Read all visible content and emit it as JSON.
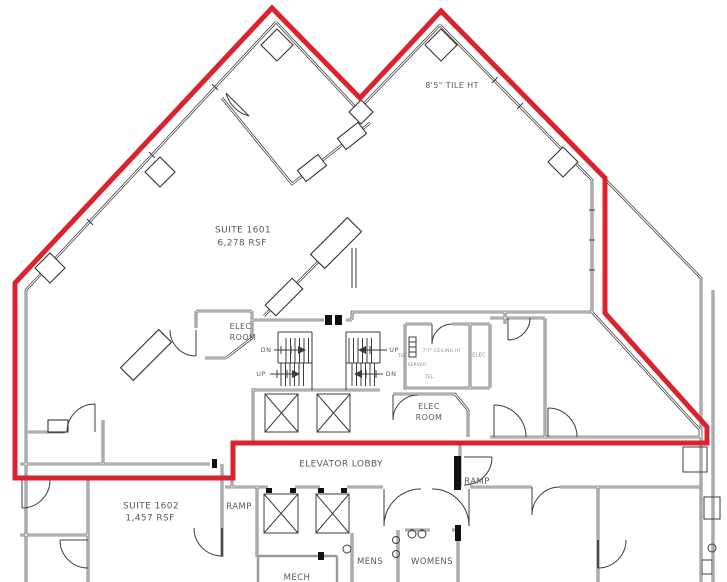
{
  "plan": {
    "colors": {
      "suite_outline": "#d9232e",
      "walls": "#2e2e2e",
      "labels": "#5a5a5a"
    },
    "labels": {
      "tile_height": "8'5\" TILE HT",
      "suite_1601_name": "SUITE 1601",
      "suite_1601_area": "6,278 RSF",
      "elec_room_left_line1": "ELEC.",
      "elec_room_left_line2": "ROOM",
      "stair_left_dn": "DN",
      "stair_left_up": "UP",
      "stair_right_up": "UP",
      "stair_right_dn": "DN",
      "server_ceiling_height": "7'7\" CEILING HT",
      "server_tel_1": "TEL.",
      "server_name": "SERVER",
      "server_tel_2": "TEL.",
      "elec_closet": "ELEC",
      "elec_room_right_line1": "ELEC",
      "elec_room_right_line2": "ROOM",
      "elevator_lobby": "ELEVATOR LOBBY",
      "ramp_right": "RAMP",
      "ramp_left": "RAMP",
      "suite_1602_name": "SUITE 1602",
      "suite_1602_area": "1,457 RSF",
      "mens": "MENS",
      "womens": "WOMENS",
      "mech": "MECH"
    }
  }
}
